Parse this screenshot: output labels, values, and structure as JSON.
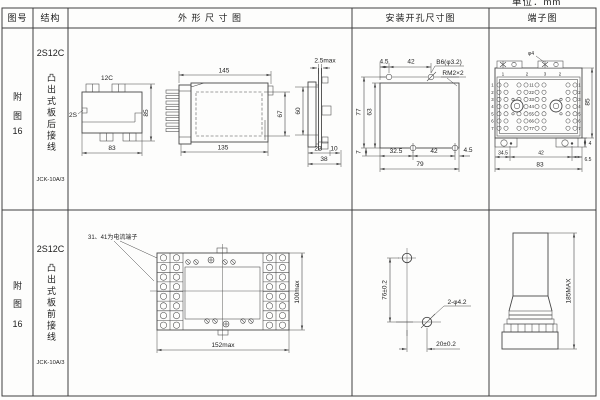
{
  "unit_label": "单位：mm",
  "header": {
    "fig_no": "图号",
    "structure": "结构",
    "outline": "外 形 尺 寸 图",
    "mounting": "安装开孔尺寸图",
    "terminal": "端子图"
  },
  "rows": [
    {
      "fig_no": {
        "l1": "附",
        "l2": "图",
        "l3": "16"
      },
      "structure": {
        "model": "2S12C",
        "desc": "凸出式板后接线",
        "type": "JCK-10A/3"
      },
      "outline": {
        "top_view": {
          "label_top": "12C",
          "label_left": "2S",
          "dim_w": "83",
          "dim_h": "85"
        },
        "side_view": {
          "dim_top": "145",
          "dim_bottom": "135",
          "dim_inner_h": "67",
          "dim_panel_h": "60"
        },
        "end_view": {
          "dim_top": "2.5max",
          "dim_d1": "22",
          "dim_d2": "10",
          "dim_d3": "38"
        }
      },
      "mounting": {
        "dim_t1": "4.5",
        "dim_t2": "42",
        "hole": "B6(φ3.2)",
        "thread": "RM2×2",
        "dim_l1": "77",
        "dim_l2": "63",
        "dim_b0": "7",
        "dim_b1": "32.5",
        "dim_b2": "42",
        "dim_b3": "4.5",
        "dim_total": "79"
      },
      "terminal": {
        "hole": "φ4",
        "top_nums": [
          "1",
          "2",
          "3",
          "2"
        ],
        "left_nums": [
          "1",
          "2",
          "3",
          "4",
          "5",
          "6",
          "7"
        ],
        "mid_nums": [
          "11",
          "22",
          "33",
          "44",
          "55",
          "66",
          "77"
        ],
        "right_nums": [
          "1",
          "2",
          "3",
          "4",
          "5",
          "6",
          "7"
        ],
        "dim_h": "85",
        "dim_tab": "4",
        "dim_b1": "34.5",
        "dim_b2": "42",
        "dim_b3": "6.5",
        "dim_total": "83"
      }
    },
    {
      "fig_no": {
        "l1": "附",
        "l2": "图",
        "l3": "16"
      },
      "structure": {
        "model": "2S12C",
        "desc": "凸出式板前接线",
        "type": "JCK-10A/3"
      },
      "outline": {
        "note": "31、41为电流端子",
        "dim_w": "152max",
        "dim_h": "100max"
      },
      "mounting": {
        "dim_v": "76±0.2",
        "dim_h": "20±0.2",
        "hole": "2-φ4.2"
      },
      "terminal": {
        "dim_h": "185MAX"
      }
    }
  ]
}
